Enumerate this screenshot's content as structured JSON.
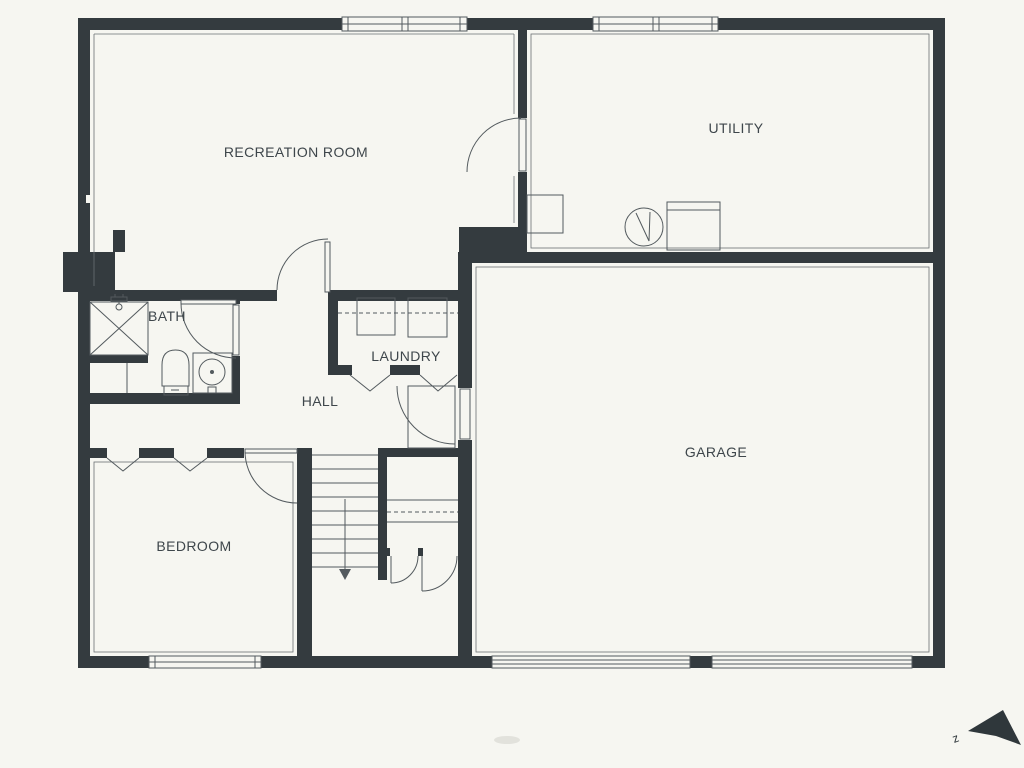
{
  "plan": {
    "title": "basement-floor-plan",
    "rooms": [
      {
        "id": "recreation-room",
        "label": "RECREATION ROOM"
      },
      {
        "id": "utility",
        "label": "UTILITY"
      },
      {
        "id": "bath",
        "label": "BATH"
      },
      {
        "id": "laundry",
        "label": "LAUNDRY"
      },
      {
        "id": "hall",
        "label": "HALL"
      },
      {
        "id": "bedroom",
        "label": "BEDROOM"
      },
      {
        "id": "garage",
        "label": "GARAGE"
      }
    ],
    "compass": {
      "label": "z"
    },
    "fixtures": [
      "shower",
      "shower-head",
      "toilet",
      "sink",
      "washer",
      "dryer",
      "water-heater",
      "furnace",
      "storage-cabinet",
      "counter",
      "stairs-down"
    ],
    "openings": {
      "windows": 3,
      "garage_doors": 2,
      "swing_doors": 7,
      "bifold_openings": 4
    },
    "colors": {
      "wall": "#343b3f",
      "background": "#f6f6f1",
      "line": "#535a5e",
      "text": "#3e464b"
    }
  }
}
